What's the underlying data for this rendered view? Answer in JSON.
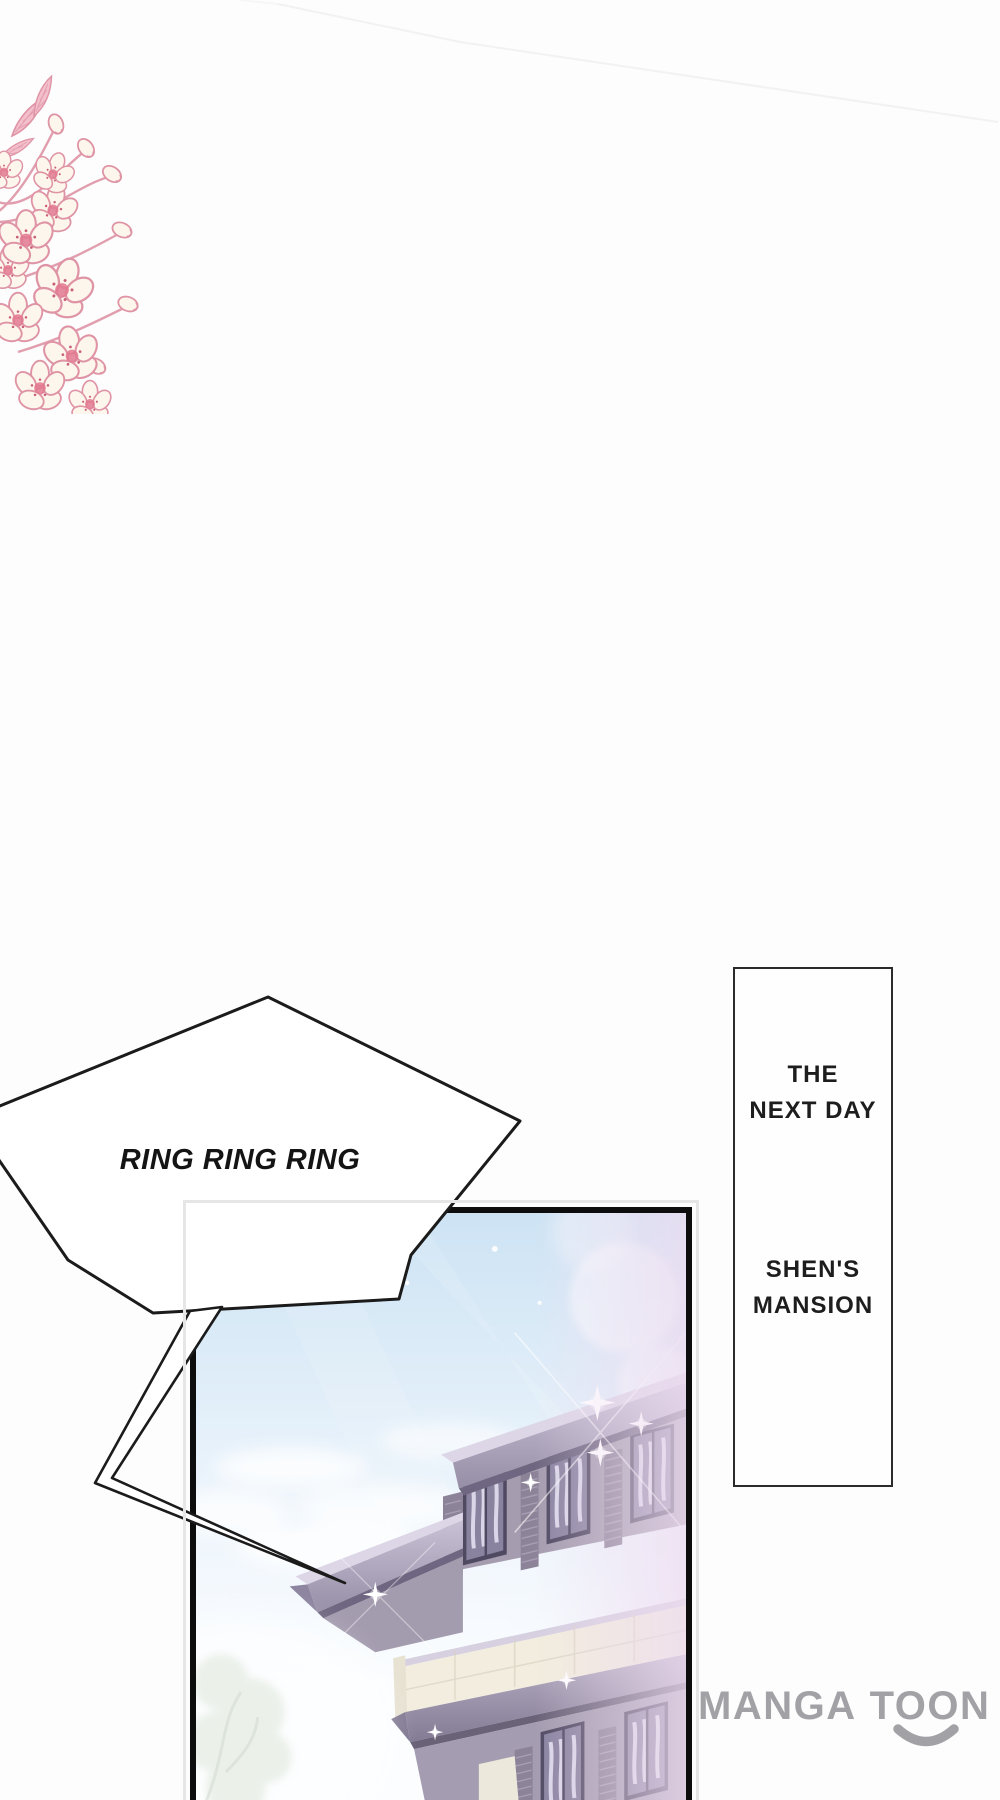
{
  "page": {
    "width": 1000,
    "height": 1800,
    "background": "#fdfdfd"
  },
  "speech_bubble": {
    "text": "RING RING RING",
    "text_color": "#141414",
    "outline_color": "#1b1b1b",
    "fill": "#ffffff"
  },
  "caption_box": {
    "border_color": "#2b2b2b",
    "fill": "#fefefe",
    "text_color": "#1d1d1d",
    "blocks": [
      {
        "lines": [
          "THE",
          "NEXT DAY"
        ]
      },
      {
        "lines": [
          "SHEN'S",
          "MANSION"
        ]
      }
    ]
  },
  "watermark": {
    "parts": [
      "MANGA",
      "TOON"
    ],
    "color": "#a2a2a6"
  },
  "panel": {
    "frame_color": "#e6e6e6",
    "border_color": "#0d0d0d",
    "sky_top": "#cde3f4",
    "sky_mid": "#eaf3fb",
    "sky_low": "#fbfdff",
    "haze_pink": "#eedcf0",
    "mansion_wall": "#a59daf",
    "mansion_roof": "#c9c2d6",
    "mansion_shadow": "#6f6781",
    "parapet": "#f2edde",
    "window_frame": "#4f4962",
    "window_glass": "#8a83a0",
    "sparkle": "#ffffff",
    "foliage": "#cfdcca"
  },
  "flower": {
    "outline": "#df94a6",
    "petal": "#fdf6ec",
    "petal_pink": "#f8d3da",
    "center": "#e2788f",
    "leaf": "#f3bfcb"
  }
}
